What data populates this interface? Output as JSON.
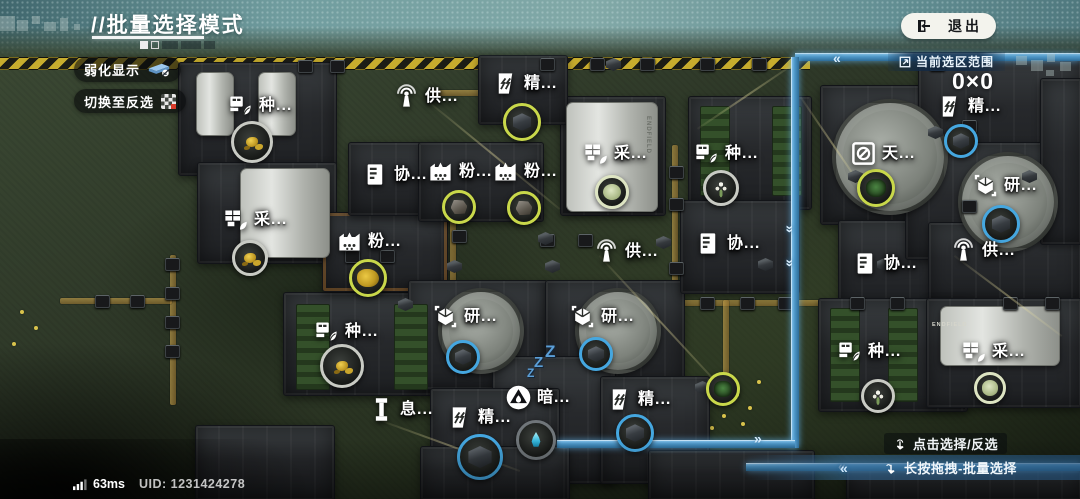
{
  "header": {
    "title": "//批量选择模式",
    "exit_label": "退出"
  },
  "panel": {
    "weaken_label": "弱化显示",
    "invert_label": "切换至反选"
  },
  "selection": {
    "range_label": "当前选区范围",
    "range_value": "0×0"
  },
  "hints": {
    "click_hint": "点击选择/反选",
    "drag_hint": "长按拖拽-批量选择"
  },
  "status": {
    "ping": "63ms",
    "uid": "UID: 1231424278"
  },
  "map": {
    "machine_brand": "ENDFIELD",
    "sleep": "ZZZ",
    "buildings": [
      {
        "label": "种...",
        "icon": "seed-icon",
        "x": 227,
        "y": 92
      },
      {
        "label": "采...",
        "icon": "mine-icon",
        "x": 222,
        "y": 206
      },
      {
        "label": "粉...",
        "icon": "grind-icon",
        "x": 336,
        "y": 228
      },
      {
        "label": "种...",
        "icon": "seed-icon",
        "x": 313,
        "y": 318
      },
      {
        "label": "息...",
        "icon": "rest-icon",
        "x": 368,
        "y": 396
      },
      {
        "label": "精...",
        "icon": "refine-icon",
        "x": 446,
        "y": 404
      },
      {
        "label": "供...",
        "icon": "supply-icon",
        "x": 393,
        "y": 83
      },
      {
        "label": "精...",
        "icon": "refine-icon",
        "x": 492,
        "y": 70
      },
      {
        "label": "协...",
        "icon": "protocol-icon",
        "x": 362,
        "y": 161
      },
      {
        "label": "粉...",
        "icon": "grind-icon",
        "x": 427,
        "y": 158
      },
      {
        "label": "粉...",
        "icon": "grind-icon",
        "x": 492,
        "y": 158
      },
      {
        "label": "采...",
        "icon": "mine-icon",
        "x": 582,
        "y": 140
      },
      {
        "label": "研...",
        "icon": "research-icon",
        "x": 432,
        "y": 303
      },
      {
        "label": "研...",
        "icon": "research-icon",
        "x": 569,
        "y": 303
      },
      {
        "label": "供...",
        "icon": "supply-icon",
        "x": 593,
        "y": 238
      },
      {
        "label": "暗...",
        "icon": "dark-icon",
        "x": 505,
        "y": 384
      },
      {
        "label": "精...",
        "icon": "refine-icon",
        "x": 606,
        "y": 386
      },
      {
        "label": "种...",
        "icon": "seed-icon",
        "x": 693,
        "y": 140
      },
      {
        "label": "协...",
        "icon": "protocol-icon",
        "x": 695,
        "y": 230
      },
      {
        "label": "天...",
        "icon": "observe-icon",
        "x": 850,
        "y": 140
      },
      {
        "label": "协...",
        "icon": "protocol-icon",
        "x": 852,
        "y": 250
      },
      {
        "label": "供...",
        "icon": "supply-icon",
        "x": 950,
        "y": 237
      },
      {
        "label": "精...",
        "icon": "refine-icon",
        "x": 936,
        "y": 93
      },
      {
        "label": "研...",
        "icon": "research-icon",
        "x": 972,
        "y": 172
      },
      {
        "label": "种...",
        "icon": "seed-icon",
        "x": 836,
        "y": 338
      },
      {
        "label": "采...",
        "icon": "mine-icon",
        "x": 960,
        "y": 338
      }
    ],
    "item_circles": [
      {
        "x": 252,
        "y": 142,
        "r": 21,
        "ring": "gray",
        "fill": "gold-flower"
      },
      {
        "x": 250,
        "y": 258,
        "r": 18,
        "ring": "gray",
        "fill": "gold-flower"
      },
      {
        "x": 368,
        "y": 278,
        "r": 19,
        "ring": "yellow",
        "fill": "gold"
      },
      {
        "x": 342,
        "y": 366,
        "r": 22,
        "ring": "gray",
        "fill": "gold-flower"
      },
      {
        "x": 522,
        "y": 122,
        "r": 19,
        "ring": "yellow",
        "fill": "cube"
      },
      {
        "x": 459,
        "y": 207,
        "r": 17,
        "ring": "yellow",
        "fill": "rock"
      },
      {
        "x": 524,
        "y": 208,
        "r": 17,
        "ring": "yellow",
        "fill": "rock"
      },
      {
        "x": 612,
        "y": 192,
        "r": 17,
        "ring": "pale",
        "fill": "pale"
      },
      {
        "x": 721,
        "y": 188,
        "r": 18,
        "ring": "gray",
        "fill": "white-flower"
      },
      {
        "x": 876,
        "y": 188,
        "r": 19,
        "ring": "yellow",
        "fill": "plant"
      },
      {
        "x": 961,
        "y": 141,
        "r": 17,
        "ring": "blue",
        "fill": "cube"
      },
      {
        "x": 1001,
        "y": 224,
        "r": 19,
        "ring": "blue",
        "fill": "cube"
      },
      {
        "x": 463,
        "y": 357,
        "r": 17,
        "ring": "blue",
        "fill": "cube"
      },
      {
        "x": 596,
        "y": 354,
        "r": 17,
        "ring": "blue",
        "fill": "cube"
      },
      {
        "x": 480,
        "y": 457,
        "r": 23,
        "ring": "blue",
        "fill": "cube"
      },
      {
        "x": 635,
        "y": 433,
        "r": 19,
        "ring": "blue",
        "fill": "cube"
      },
      {
        "x": 536,
        "y": 440,
        "r": 20,
        "ring": "dark",
        "fill": "drop"
      },
      {
        "x": 723,
        "y": 389,
        "r": 17,
        "ring": "yellow",
        "fill": "plant"
      },
      {
        "x": 878,
        "y": 396,
        "r": 17,
        "ring": "gray",
        "fill": "white-flower"
      },
      {
        "x": 990,
        "y": 388,
        "r": 16,
        "ring": "pale",
        "fill": "pale"
      }
    ]
  },
  "colors": {
    "conveyor_blue": "#4e98c9",
    "ring_yellow": "#c9d84a",
    "ring_blue": "#45a7e0",
    "hazard_yellow": "#d4b62e",
    "accent_orange": "#cd8734",
    "header_teal": "#96c4c7",
    "exit_pill": "#f3f3ed"
  }
}
